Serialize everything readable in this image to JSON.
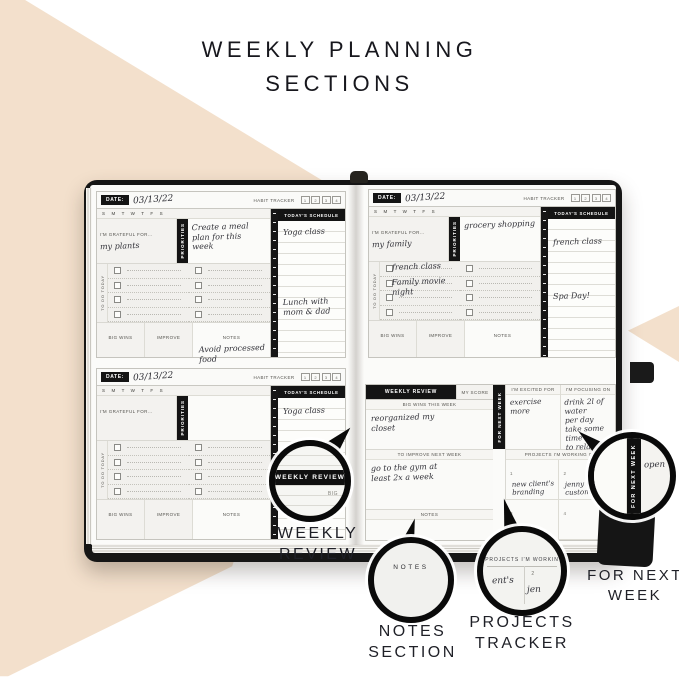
{
  "title": {
    "line1": "WEEKLY PLANNING",
    "line2": "SECTIONS"
  },
  "colors": {
    "beige": "#f3e0cc",
    "ink": "#17171d",
    "cover_black": "#161616"
  },
  "planner_labels": {
    "date": "DATE:",
    "habit_tracker": "HABIT TRACKER",
    "habit_numbers": [
      "1",
      "2",
      "3",
      "4"
    ],
    "week_days": "S M T W T F S",
    "grateful": "I'M GRATEFUL FOR...",
    "priorities": "PRIORITIES",
    "todo": "TO DO TODAY",
    "big_wins": "BIG WINS",
    "improve": "IMPROVE",
    "notes": "NOTES",
    "schedule": "TODAY'S SCHEDULE"
  },
  "daily_pages": [
    {
      "date": "03/13/22",
      "grateful_entry": "my plants",
      "priorities_entry": "Create a meal\nplan for this\nweek",
      "todo_entry1": "",
      "todo_entry2": "",
      "schedule_entry1": "Yoga class",
      "schedule_entry2": "Lunch with mom & dad",
      "notes_entry": "Avoid processed\nfood"
    },
    {
      "date": "03/13/22",
      "grateful_entry": "my family",
      "priorities_entry": "grocery shopping",
      "todo_entry1": "french class",
      "todo_entry2": "Family movie\nnight",
      "schedule_entry1": "french class",
      "schedule_entry2": "Spa Day!",
      "notes_entry": ""
    },
    {
      "date": "03/13/22",
      "grateful_entry": "",
      "priorities_entry": "",
      "todo_entry1": "",
      "todo_entry2": "",
      "schedule_entry1": "Yoga class",
      "schedule_entry2": "",
      "notes_entry": ""
    }
  ],
  "weekly_review": {
    "header": "WEEKLY REVIEW",
    "my_score": "MY SCORE",
    "big_wins_label": "BIG WINS THIS WEEK",
    "big_wins_entry": "reorganized my\ncloset",
    "next_week_tab": "FOR NEXT WEEK",
    "excited_label": "I'M EXCITED FOR",
    "excited_entry": "exercise more",
    "focusing_label": "I'M FOCUSING ON",
    "focusing_entry": "drink 2l of water\nper day\ntake some time\nto relax",
    "improve_label": "TO IMPROVE NEXT WEEK",
    "improve_entry": "go to the gym at\nleast 2x a week",
    "notes_label": "NOTES",
    "projects_label": "PROJECTS I'M WORKING ON",
    "projects": [
      {
        "num": "1",
        "entry": "new client's\nbranding"
      },
      {
        "num": "2",
        "entry": "jenny 07's\ncustomization"
      },
      {
        "num": "3",
        "entry": ""
      },
      {
        "num": "4",
        "entry": ""
      }
    ]
  },
  "callouts": {
    "weekly_review": {
      "magnified": "WEEKLY REVIEW",
      "partial": "BIG",
      "label1": "WEEKLY",
      "label2": "REVIEW"
    },
    "notes": {
      "magnified": "NOTES",
      "label1": "NOTES",
      "label2": "SECTION"
    },
    "projects": {
      "magnified": "PROJECTS I'M WORKIN",
      "script_a": "ent's",
      "num": "2",
      "script_b": "jen",
      "label1": "PROJECTS",
      "label2": "TRACKER"
    },
    "next_week": {
      "magnified": "FOR NEXT WEEK",
      "script": "open",
      "label1": "FOR NEXT",
      "label2": "WEEK"
    }
  }
}
